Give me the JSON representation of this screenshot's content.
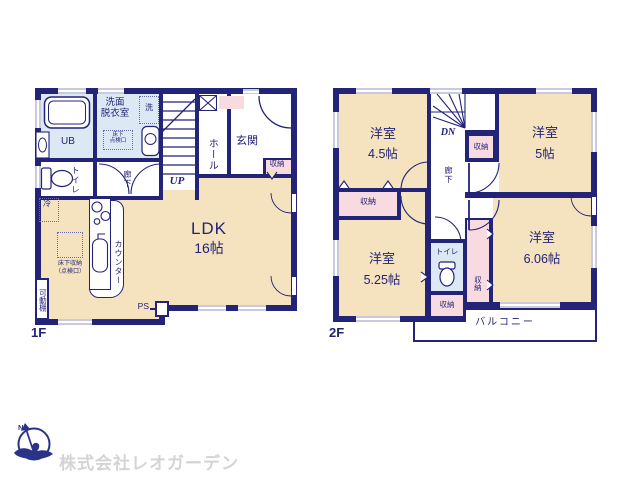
{
  "colors": {
    "wall": "#232377",
    "room_cream": "#f5e2bf",
    "bath_blue": "#dce8f3",
    "closet_pink": "#f8dbe0",
    "logo_blue": "#2b3389",
    "company_gray": "#d4d4d4"
  },
  "f1": {
    "floor_label": "1F",
    "ldk": "LDK",
    "ldk_size": "16帖",
    "ub": "UB",
    "senmen_l1": "洗面",
    "senmen_l2": "脱衣室",
    "sen": "洗",
    "tenken_l1": "床下",
    "tenken_l2": "点検口",
    "toilet": "トイレ",
    "rouka": "廊下",
    "hall": "ホール",
    "genkan": "玄関",
    "shuno": "収納",
    "up": "UP",
    "rei": "冷",
    "yukashita_l1": "床下収納",
    "yukashita_l2": "（点検口）",
    "counter": "カウンター",
    "kadodana": "可動棚",
    "ps": "PS"
  },
  "f2": {
    "floor_label": "2F",
    "dn": "DN",
    "rouka": "廊下",
    "toilet": "トイレ",
    "shuno": "収納",
    "balcony": "バルコニー",
    "rooms": [
      {
        "name": "洋室",
        "size": "4.5帖"
      },
      {
        "name": "洋室",
        "size": "5帖"
      },
      {
        "name": "洋室",
        "size": "5.25帖"
      },
      {
        "name": "洋室",
        "size": "6.06帖"
      }
    ]
  },
  "footer": {
    "company": "株式会社レオガーデン",
    "compass": "N"
  }
}
